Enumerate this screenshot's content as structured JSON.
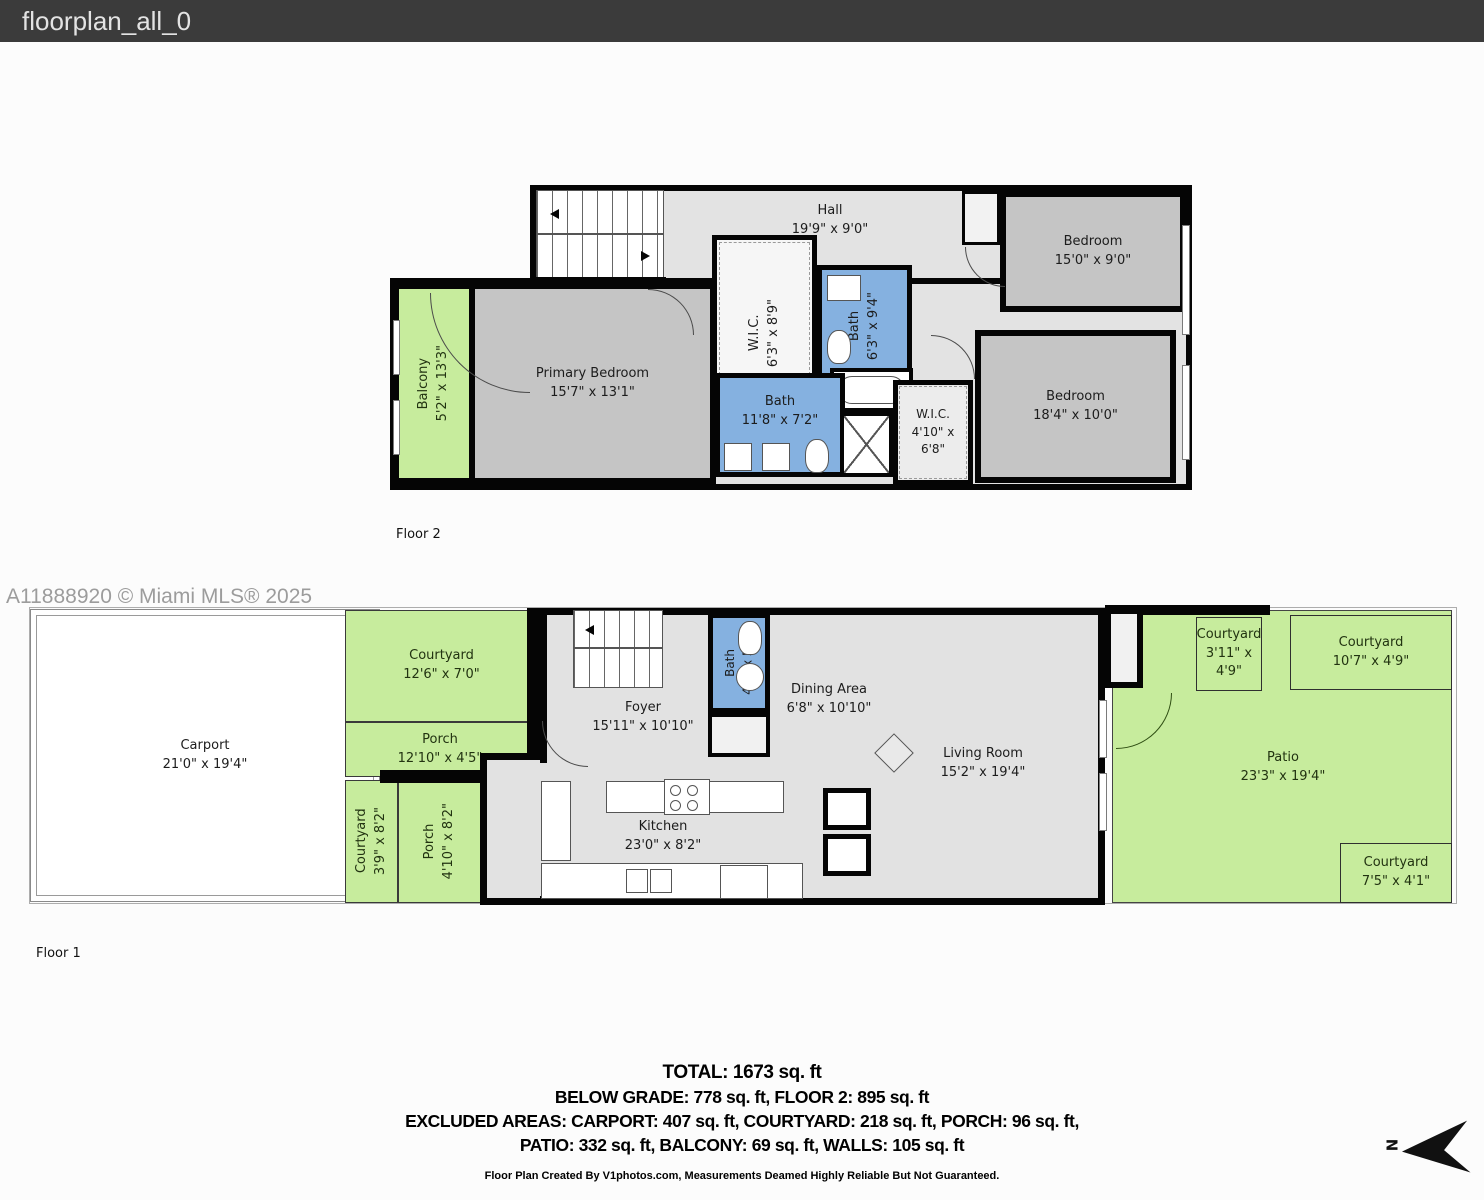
{
  "header": {
    "title": "floorplan_all_0"
  },
  "watermark": "A11888920 © Miami MLS® 2025",
  "colors": {
    "wall": "#050505",
    "outdoor_green": "#c7ec9d",
    "bath_blue": "#85b1e0",
    "bedroom_grey": "#c5c5c5",
    "floor_grey": "#e3e3e3",
    "header_bg": "#3b3b3b"
  },
  "floor2": {
    "label": "Floor 2",
    "rooms": [
      {
        "name": "Hall",
        "dims": "19'9\" x 9'0\""
      },
      {
        "name": "Bedroom",
        "dims": "15'0\" x 9'0\""
      },
      {
        "name": "Balcony",
        "dims": "5'2\" x 13'3\""
      },
      {
        "name": "Primary Bedroom",
        "dims": "15'7\" x 13'1\""
      },
      {
        "name": "W.I.C.",
        "dims": "6'3\" x 8'9\""
      },
      {
        "name": "Bath",
        "dims": "6'3\" x 9'4\""
      },
      {
        "name": "Bath",
        "dims": "11'8\" x 7'2\""
      },
      {
        "name": "W.I.C.",
        "dims": "4'10\" x 6'8\""
      },
      {
        "name": "Bedroom",
        "dims": "18'4\" x 10'0\""
      }
    ]
  },
  "floor1": {
    "label": "Floor 1",
    "rooms": [
      {
        "name": "Carport",
        "dims": "21'0\" x 19'4\""
      },
      {
        "name": "Courtyard",
        "dims": "12'6\" x 7'0\""
      },
      {
        "name": "Porch",
        "dims": "12'10\" x 4'5\""
      },
      {
        "name": "Courtyard",
        "dims": "3'9\" x 8'2\""
      },
      {
        "name": "Porch",
        "dims": "4'10\" x 8'2\""
      },
      {
        "name": "Foyer",
        "dims": "15'11\" x 10'10\""
      },
      {
        "name": "Bath",
        "dims": "4'0\" x 5'9\""
      },
      {
        "name": "Dining Area",
        "dims": "6'8\" x 10'10\""
      },
      {
        "name": "Kitchen",
        "dims": "23'0\" x 8'2\""
      },
      {
        "name": "Living Room",
        "dims": "15'2\" x 19'4\""
      },
      {
        "name": "Patio",
        "dims": "23'3\" x 19'4\""
      },
      {
        "name": "Courtyard",
        "dims": "3'11\" x 4'9\""
      },
      {
        "name": "Courtyard",
        "dims": "10'7\" x 4'9\""
      },
      {
        "name": "Courtyard",
        "dims": "7'5\" x 4'1\""
      }
    ]
  },
  "summary": {
    "total": "TOTAL: 1673 sq. ft",
    "line2": "BELOW GRADE: 778 sq. ft, FLOOR 2: 895 sq. ft",
    "line3": "EXCLUDED AREAS: CARPORT: 407 sq. ft, COURTYARD: 218 sq. ft, PORCH: 96 sq. ft,",
    "line4": "PATIO: 332 sq. ft, BALCONY: 69 sq. ft, WALLS: 105 sq. ft",
    "credit": "Floor Plan Created By V1photos.com, Measurements Deamed Highly Reliable But Not Guaranteed."
  },
  "compass": {
    "label": "N"
  }
}
